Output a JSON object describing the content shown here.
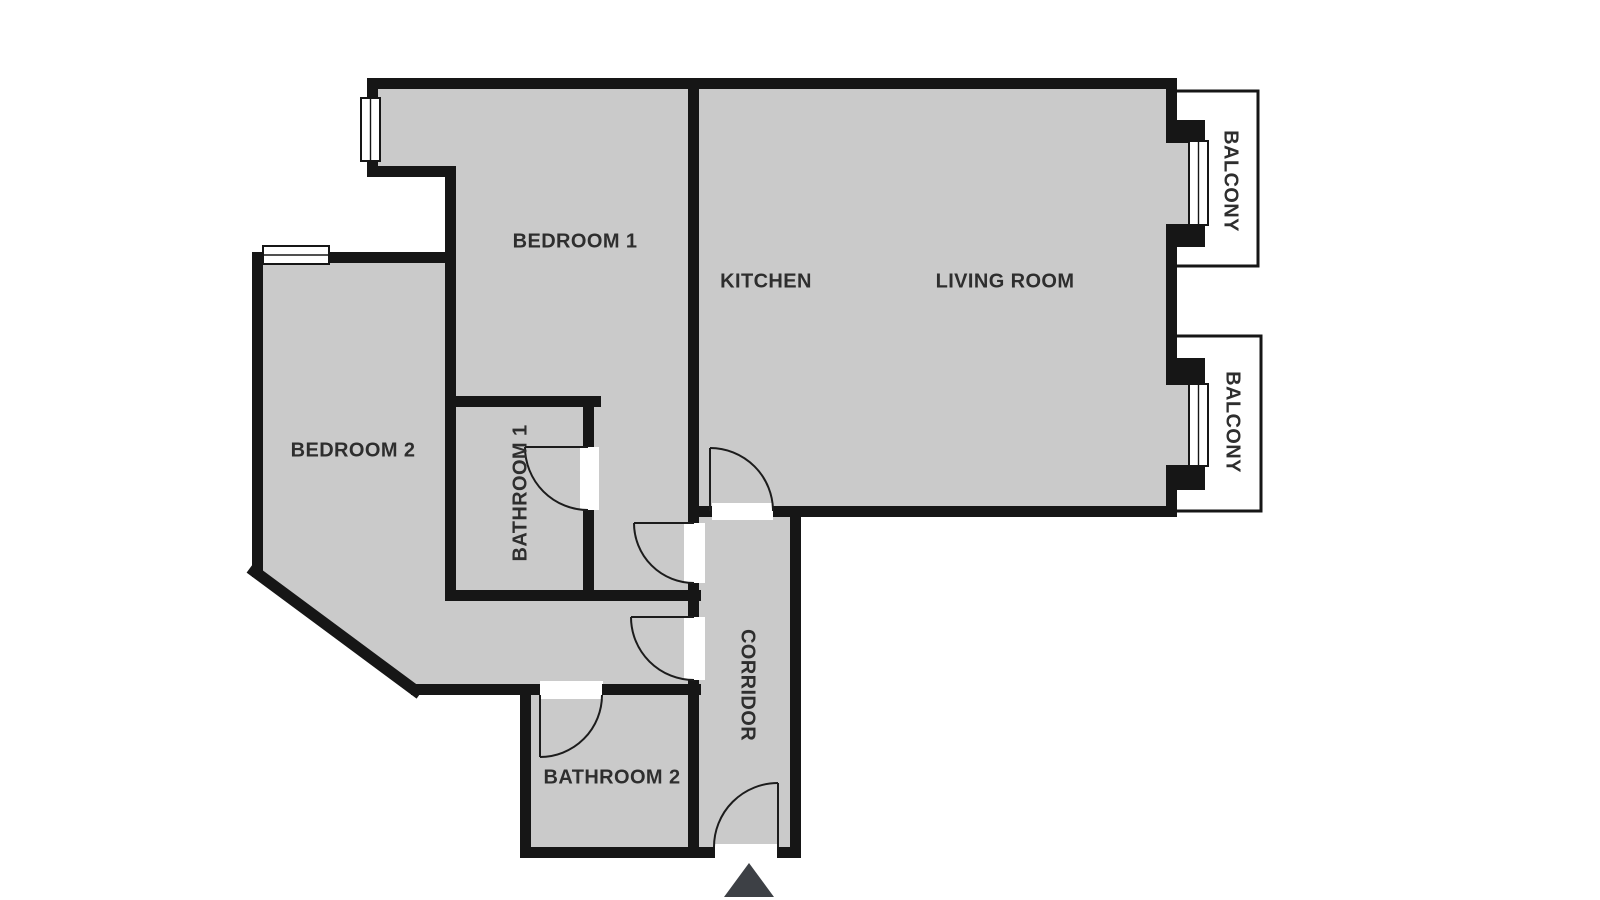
{
  "colors": {
    "floor": "#cacaca",
    "wall": "#161616",
    "balcony_fill": "#ffffff",
    "door_stroke": "#1c1c1c",
    "label_text": "#2e2e2e",
    "arrow": "#3d4045"
  },
  "rooms": {
    "bedroom1": {
      "label": "BEDROOM 1"
    },
    "bedroom2": {
      "label": "BEDROOM 2"
    },
    "kitchen": {
      "label": "KITCHEN"
    },
    "living_room": {
      "label": "LIVING ROOM"
    },
    "bathroom1": {
      "label": "BATHROOM 1"
    },
    "bathroom2": {
      "label": "BATHROOM 2"
    },
    "corridor": {
      "label": "CORRIDOR"
    },
    "balcony1": {
      "label": "BALCONY"
    },
    "balcony2": {
      "label": "BALCONY"
    }
  },
  "icons": {
    "entrance_arrow": "up-triangle"
  }
}
